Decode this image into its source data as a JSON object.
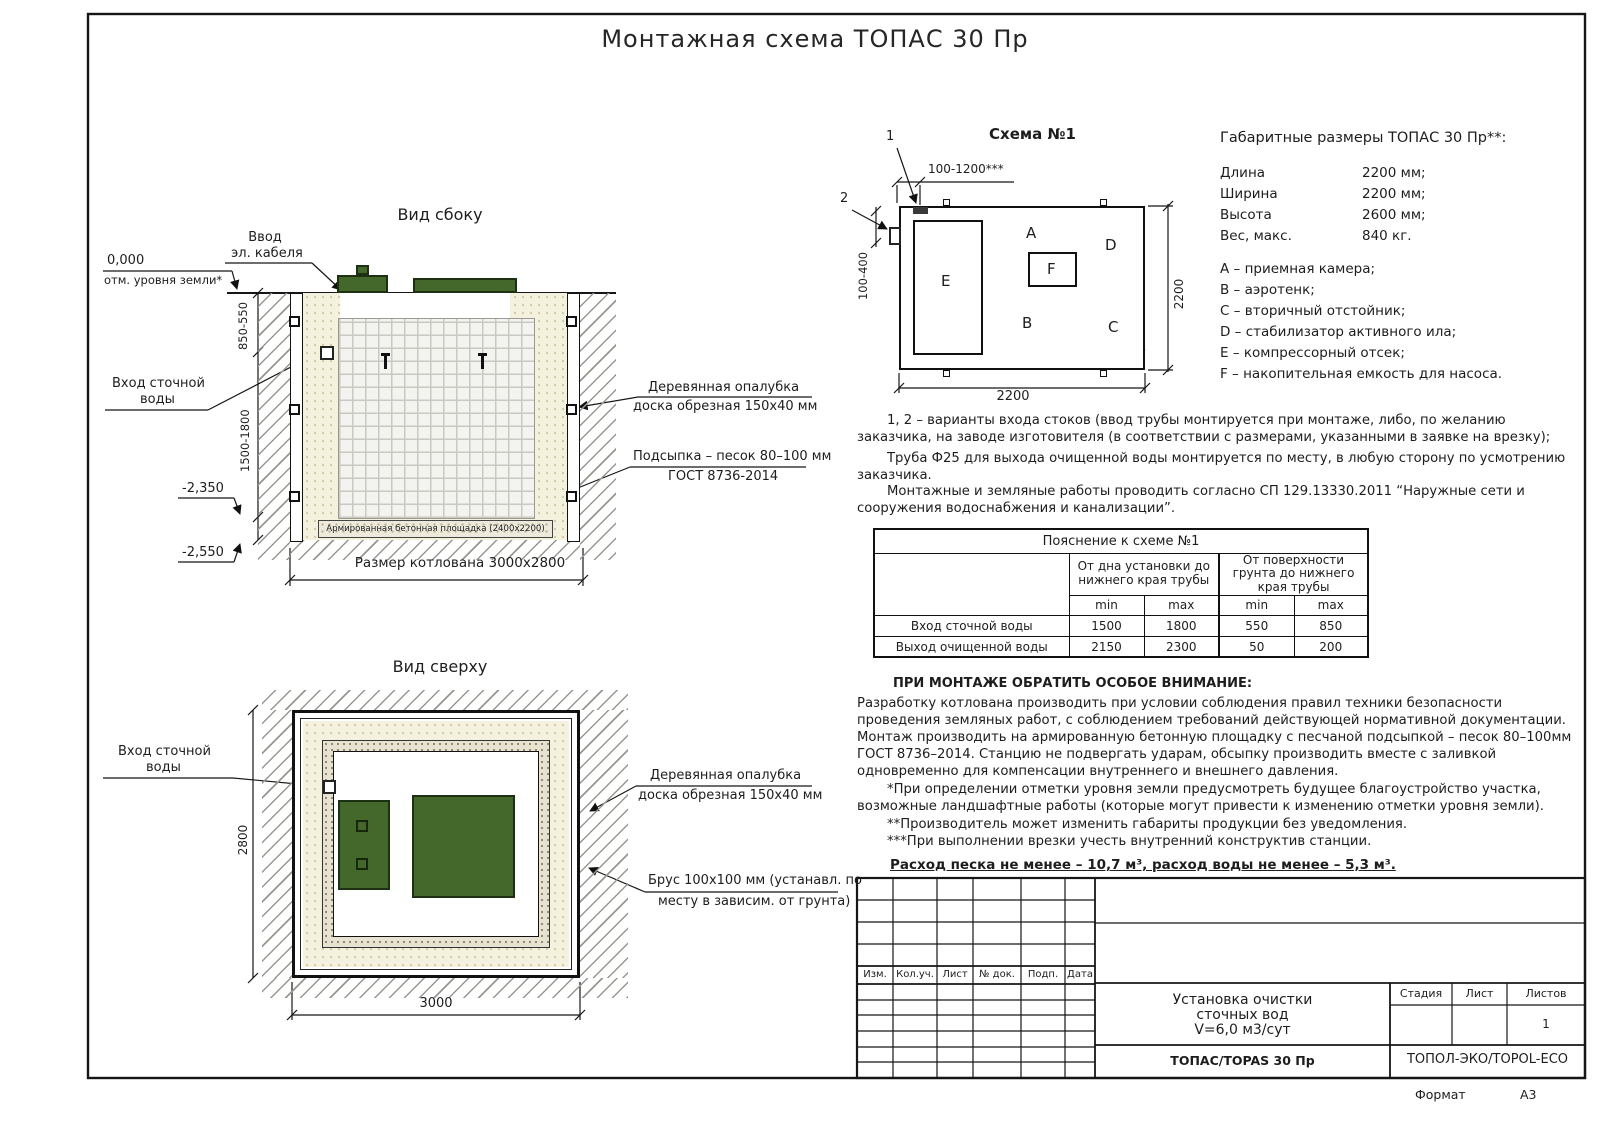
{
  "page": {
    "title": "Монтажная схема ТОПАС 30 Пр",
    "format_label": "Формат",
    "format_value": "А3"
  },
  "colors": {
    "lid_green": "#44682c",
    "dashed_green": "#4e7a3c"
  },
  "side_view": {
    "title": "Вид сбоку",
    "cable_line1": "Ввод",
    "cable_line2": "эл. кабеля",
    "zero_mark": "0,000",
    "ground_note": "отм. уровня земли*",
    "inlet_line1": "Вход сточной",
    "inlet_line2": "воды",
    "dim_upper": "850-550",
    "dim_lower": "1500-1800",
    "mark_minus2350": "-2,350",
    "mark_minus2550": "-2,550",
    "formwork_line1": "Деревянная опалубка",
    "formwork_line2": "доска обрезная 150х40 мм",
    "bedding_line1": "Подсыпка – песок 80–100 мм",
    "bedding_line2": "ГОСТ 8736-2014",
    "slab_label": "Армированная бетонная площадка (2400х2200)",
    "pit_dim": "Размер котлована 3000х2800"
  },
  "top_view": {
    "title": "Вид сверху",
    "inlet_line1": "Вход сточной",
    "inlet_line2": "воды",
    "formwork_line1": "Деревянная опалубка",
    "formwork_line2": "доска обрезная 150х40 мм",
    "beam_line1": "Брус 100х100 мм (устанавл. по",
    "beam_line2": "месту в зависим. от грунта)",
    "dim_height": "2800",
    "dim_width": "3000"
  },
  "schema": {
    "title": "Схема №1",
    "callout_1": "1",
    "callout_2": "2",
    "dim_top": "100-1200***",
    "dim_left": "100-400",
    "dim_right": "2200",
    "dim_bottom": "2200",
    "comp_a": "A",
    "comp_b": "B",
    "comp_c": "C",
    "comp_d": "D",
    "comp_e": "E",
    "comp_f": "F"
  },
  "specs": {
    "title": "Габаритные размеры ТОПАС 30 Пр**:",
    "rows": [
      {
        "name": "Длина",
        "value": "2200 мм;"
      },
      {
        "name": "Ширина",
        "value": "2200 мм;"
      },
      {
        "name": "Высота",
        "value": "2600 мм;"
      },
      {
        "name": "Вес, макс.",
        "value": "840 кг."
      }
    ],
    "legend": [
      "A – приемная камера;",
      "B – аэротенк;",
      "C – вторичный отстойник;",
      "D – стабилизатор активного ила;",
      "E – компрессорный отсек;",
      "F – накопительная емкость для насоса."
    ]
  },
  "notes": {
    "variants": "1, 2 – варианты входа  стоков (ввод трубы монтируется при монтаже, либо, по желанию заказчика, на заводе изготовителя (в соответствии с размерами, указанными в заявке на врезку);",
    "pipe": "Труба Ф25 для выхода очищенной воды монтируется по месту, в любую сторону по усмотрению заказчика.",
    "works": "Монтажные и земляные работы проводить согласно СП 129.13330.2011 “Наружные сети и сооружения водоснабжения и канализации”."
  },
  "table": {
    "title": "Пояснение к схеме №1",
    "col_group_1": "От дна установки до нижнего края трубы",
    "col_group_2": "От поверхности грунта до нижнего края трубы",
    "min_label": "min",
    "max_label": "max",
    "rows": [
      {
        "label": "Вход сточной воды",
        "values": [
          "1500",
          "1800",
          "550",
          "850"
        ]
      },
      {
        "label": "Выход очищенной воды",
        "values": [
          "2150",
          "2300",
          "50",
          "200"
        ]
      }
    ]
  },
  "attention": {
    "heading": "ПРИ МОНТАЖЕ ОБРАТИТЬ ОСОБОЕ ВНИМАНИЕ:",
    "body": "Разработку котлована производить при условии соблюдения правил техники безопасности проведения земляных работ, с соблюдением требований действующей нормативной документации.  Монтаж производить на армированную бетонную площадку с песчаной подсыпкой – песок 80–100мм ГОСТ 8736–2014. Станцию не подвергать ударам, обсыпку производить вместе с заливкой одновременно для компенсации внутреннего и внешнего давления.",
    "footnote_1": "*При определении отметки уровня земли предусмотреть будущее благоустройство участка, возможные ландшафтные работы (которые могут привести к изменению отметки уровня земли).",
    "footnote_2": "**Производитель может изменить габариты продукции без уведомления.",
    "footnote_3": "***При выполнении врезки учесть внутренний конструктив станции.",
    "consumption": "Расход песка не менее – 10,7 м³, расход воды не менее – 5,3 м³."
  },
  "title_block": {
    "col_headers": [
      "Изм.",
      "Кол.уч.",
      "Лист",
      "№ док.",
      "Подп.",
      "Дата"
    ],
    "doc_name_line1": "Установка очистки",
    "doc_name_line2": "сточных вод",
    "doc_name_line3": "V=6,0 м3/сут",
    "stage_label": "Стадия",
    "sheet_label": "Лист",
    "sheets_label": "Листов",
    "sheets_value": "1",
    "product": "ТОПАС/TOPAS 30 Пр",
    "company": "ТОПОЛ-ЭКО/TOPOL-ECO"
  }
}
